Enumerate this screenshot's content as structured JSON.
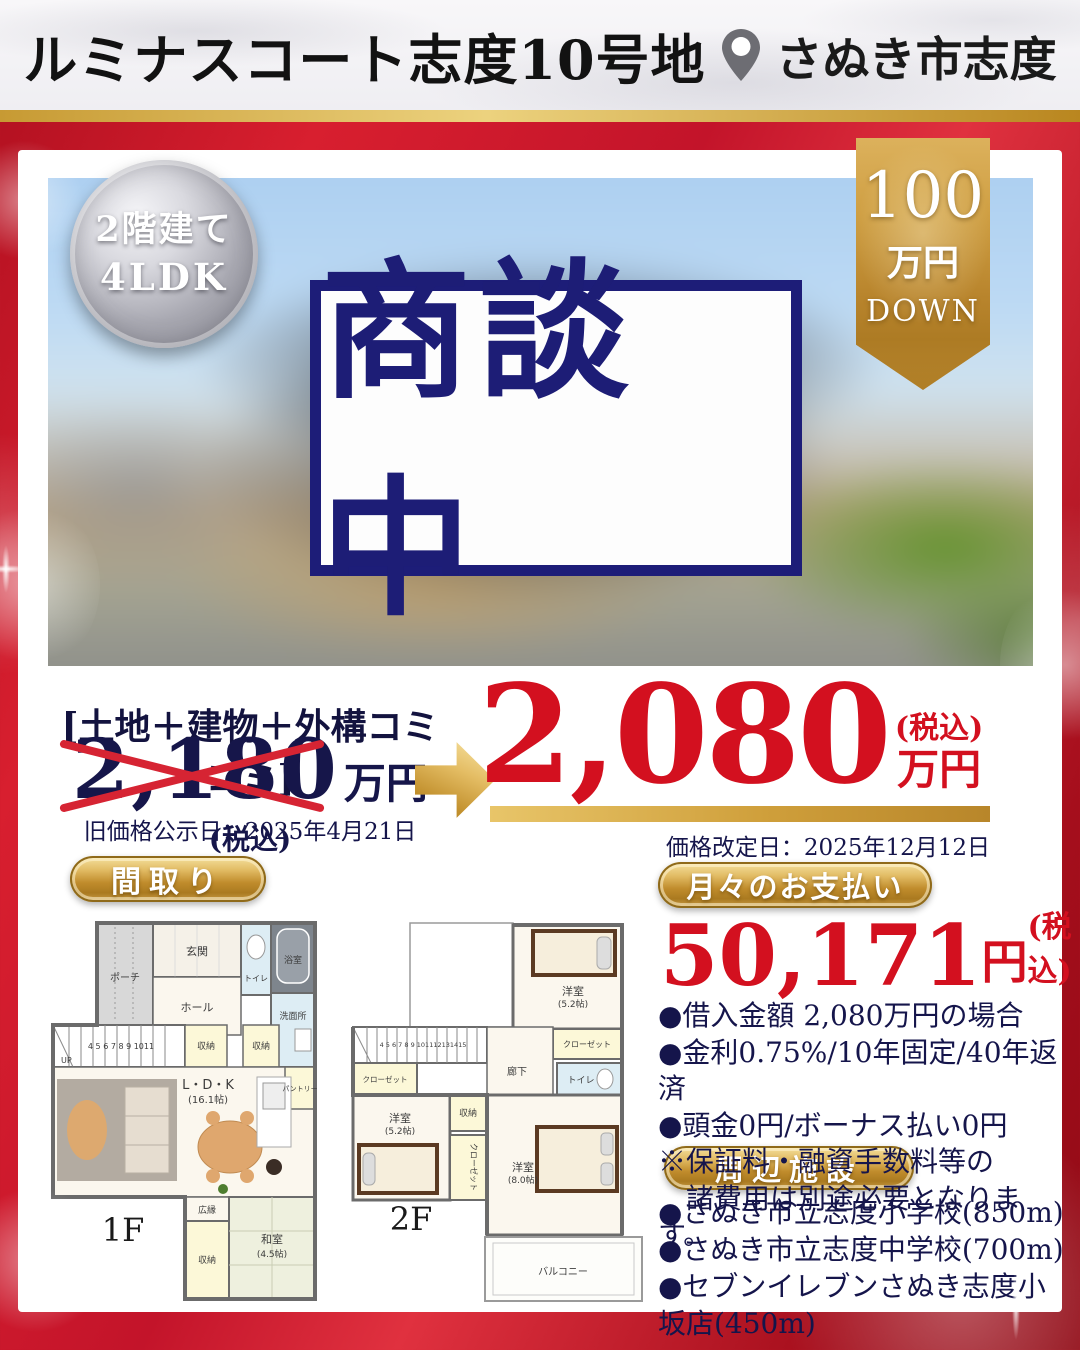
{
  "colors": {
    "frame_red": "#c3142a",
    "navy": "#1d1d76",
    "price_red": "#d3101f",
    "gold": "#c9973b",
    "silver_badge": "#a9a9b2"
  },
  "header": {
    "title": "ルミナスコート志度10号地",
    "location": "さぬき市志度"
  },
  "spec_badge": {
    "line1": "2階建て",
    "line2": "4LDK"
  },
  "ribbon": {
    "amount": "100",
    "unit": "万円",
    "down": "DOWN"
  },
  "status": {
    "label": "商談中"
  },
  "pricing": {
    "package_label": "[土地＋建物＋外構コミコミ]",
    "old_price": "2,180",
    "old_unit": "万円",
    "old_tax": "(税込)",
    "old_date": "旧価格公示日：2025年4月21日",
    "new_price": "2,080",
    "new_tax": "(税込)",
    "new_unit": "万円",
    "new_date": "価格改定日：2025年12月12日"
  },
  "floorplan": {
    "section_label": "間取り",
    "f1": {
      "floor": "1F",
      "labels": {
        "porch": "ポーチ",
        "genkan": "玄関",
        "hall": "ホール",
        "toilet": "トイレ",
        "bath": "浴室",
        "wash": "洗面所",
        "storage1": "収納",
        "storage2": "収納",
        "pantry": "パントリー",
        "ldk": "L・D・K",
        "ldk_size": "(16.1帖)",
        "up": "UP",
        "stairs": "4 5 6 7 8 9 1011",
        "hiroen": "広縁",
        "storage3": "収納",
        "washitsu": "和室",
        "washitsu_size": "(4.5帖)"
      }
    },
    "f2": {
      "floor": "2F",
      "labels": {
        "bedroom1": "洋室",
        "bedroom1_size": "(5.2帖)",
        "closet1": "クローゼット",
        "hallway": "廊下",
        "toilet": "トイレ",
        "closet2": "クローゼット",
        "bedroom2": "洋室",
        "bedroom2_size": "(5.2帖)",
        "storage": "収納",
        "closet3": "クローゼット",
        "bedroom3": "洋室",
        "bedroom3_size": "(8.0帖)",
        "balcony": "バルコニー",
        "stairs": "4 5 6 7 8 9 101112131415"
      }
    }
  },
  "payment": {
    "section_label": "月々のお支払い",
    "amount": "50,171",
    "unit": "円",
    "tax": "(税込)",
    "notes": [
      "●借入金額 2,080万円の場合",
      "●金利0.75%/10年固定/40年返済",
      "●頭金0円/ボーナス払い0円",
      "※保証料・融資手数料等の",
      "　諸費用は別途必要となります。"
    ]
  },
  "facilities": {
    "section_label": "周辺施設",
    "items": [
      "●さぬき市立志度小学校(850m)",
      "●さぬき市立志度中学校(700m)",
      "●セブンイレブンさぬき志度小坂店(450m)"
    ]
  }
}
